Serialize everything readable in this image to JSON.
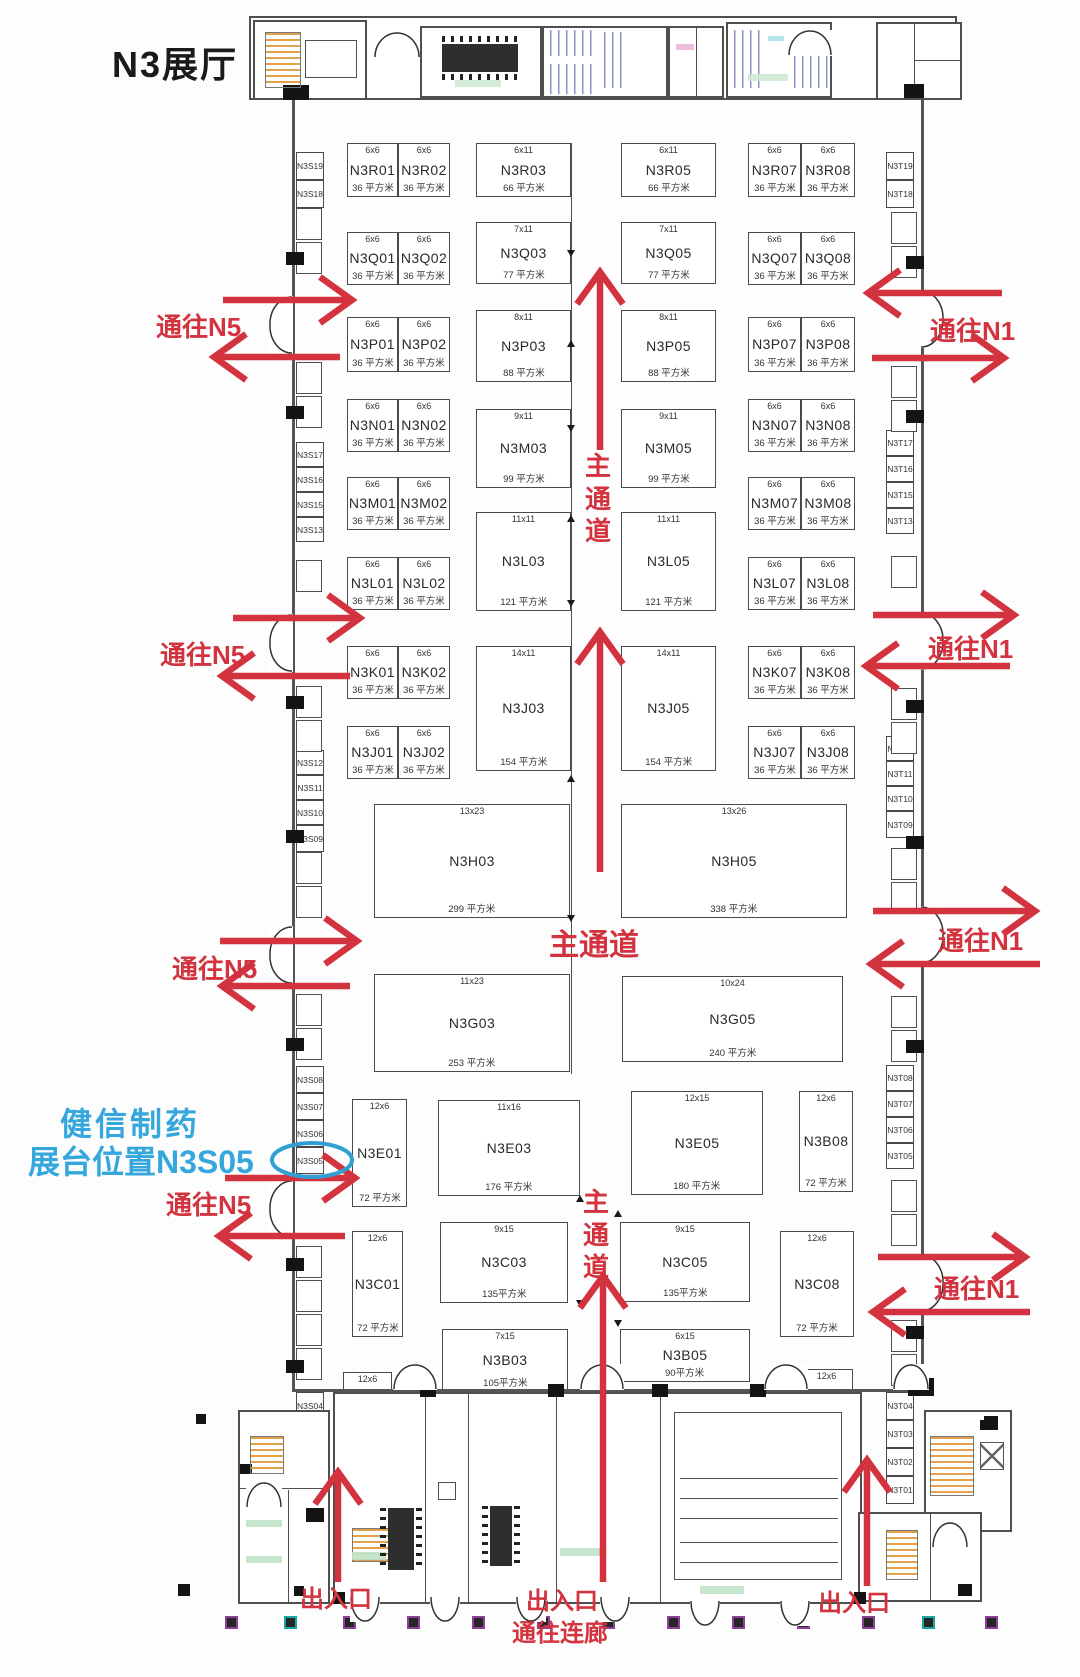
{
  "title": "N3展厅",
  "colors": {
    "red": "#d2333e",
    "blue": "#35a7dc",
    "ink": "#1a1a1a",
    "line": "#4a4a4a",
    "stair_orange": "#e2a24b",
    "column_purple": "#8e3f98",
    "column_teal": "#17a8a2"
  },
  "highlight": {
    "company": "健信制药",
    "location_label": "展台位置N3S05",
    "booth": "N3S05"
  },
  "booths": [
    {
      "name": "N3R01",
      "dim": "6x6",
      "area": "36 平方米",
      "x": 347,
      "y": 143,
      "w": 51,
      "h": 54
    },
    {
      "name": "N3R02",
      "dim": "6x6",
      "area": "36 平方米",
      "x": 398,
      "y": 143,
      "w": 52,
      "h": 54
    },
    {
      "name": "N3R03",
      "dim": "6x11",
      "area": "66 平方米",
      "x": 476,
      "y": 143,
      "w": 95,
      "h": 54
    },
    {
      "name": "N3R05",
      "dim": "6x11",
      "area": "66 平方米",
      "x": 621,
      "y": 143,
      "w": 95,
      "h": 54
    },
    {
      "name": "N3R07",
      "dim": "6x6",
      "area": "36 平方米",
      "x": 748,
      "y": 143,
      "w": 53,
      "h": 54
    },
    {
      "name": "N3R08",
      "dim": "6x6",
      "area": "36 平方米",
      "x": 801,
      "y": 143,
      "w": 54,
      "h": 54
    },
    {
      "name": "N3Q01",
      "dim": "6x6",
      "area": "36 平方米",
      "x": 347,
      "y": 232,
      "w": 51,
      "h": 53
    },
    {
      "name": "N3Q02",
      "dim": "6x6",
      "area": "36 平方米",
      "x": 398,
      "y": 232,
      "w": 52,
      "h": 53
    },
    {
      "name": "N3Q03",
      "dim": "7x11",
      "area": "77 平方米",
      "x": 476,
      "y": 222,
      "w": 95,
      "h": 62
    },
    {
      "name": "N3Q05",
      "dim": "7x11",
      "area": "77 平方米",
      "x": 621,
      "y": 222,
      "w": 95,
      "h": 62
    },
    {
      "name": "N3Q07",
      "dim": "6x6",
      "area": "36 平方米",
      "x": 748,
      "y": 232,
      "w": 53,
      "h": 53
    },
    {
      "name": "N3Q08",
      "dim": "6x6",
      "area": "36 平方米",
      "x": 801,
      "y": 232,
      "w": 54,
      "h": 53
    },
    {
      "name": "N3P01",
      "dim": "6x6",
      "area": "36 平方米",
      "x": 347,
      "y": 317,
      "w": 51,
      "h": 55
    },
    {
      "name": "N3P02",
      "dim": "6x6",
      "area": "36 平方米",
      "x": 398,
      "y": 317,
      "w": 52,
      "h": 55
    },
    {
      "name": "N3P03",
      "dim": "8x11",
      "area": "88 平方米",
      "x": 476,
      "y": 310,
      "w": 95,
      "h": 72
    },
    {
      "name": "N3P05",
      "dim": "8x11",
      "area": "88 平方米",
      "x": 621,
      "y": 310,
      "w": 95,
      "h": 72
    },
    {
      "name": "N3P07",
      "dim": "6x6",
      "area": "36 平方米",
      "x": 748,
      "y": 317,
      "w": 53,
      "h": 55
    },
    {
      "name": "N3P08",
      "dim": "6x6",
      "area": "36 平方米",
      "x": 801,
      "y": 317,
      "w": 54,
      "h": 55
    },
    {
      "name": "N3N01",
      "dim": "6x6",
      "area": "36 平方米",
      "x": 347,
      "y": 399,
      "w": 51,
      "h": 53
    },
    {
      "name": "N3N02",
      "dim": "6x6",
      "area": "36 平方米",
      "x": 398,
      "y": 399,
      "w": 52,
      "h": 53
    },
    {
      "name": "N3N07",
      "dim": "6x6",
      "area": "36 平方米",
      "x": 748,
      "y": 399,
      "w": 53,
      "h": 53
    },
    {
      "name": "N3N08",
      "dim": "6x6",
      "area": "36 平方米",
      "x": 801,
      "y": 399,
      "w": 54,
      "h": 53
    },
    {
      "name": "N3M03",
      "dim": "9x11",
      "area": "99 平方米",
      "x": 476,
      "y": 409,
      "w": 95,
      "h": 79
    },
    {
      "name": "N3M05",
      "dim": "9x11",
      "area": "99 平方米",
      "x": 621,
      "y": 409,
      "w": 95,
      "h": 79
    },
    {
      "name": "N3M01",
      "dim": "6x6",
      "area": "36 平方米",
      "x": 347,
      "y": 477,
      "w": 51,
      "h": 53
    },
    {
      "name": "N3M02",
      "dim": "6x6",
      "area": "36 平方米",
      "x": 398,
      "y": 477,
      "w": 52,
      "h": 53
    },
    {
      "name": "N3M07",
      "dim": "6x6",
      "area": "36 平方米",
      "x": 748,
      "y": 477,
      "w": 53,
      "h": 53
    },
    {
      "name": "N3M08",
      "dim": "6x6",
      "area": "36 平方米",
      "x": 801,
      "y": 477,
      "w": 54,
      "h": 53
    },
    {
      "name": "N3L03",
      "dim": "11x11",
      "area": "121 平方米",
      "x": 476,
      "y": 512,
      "w": 95,
      "h": 99
    },
    {
      "name": "N3L05",
      "dim": "11x11",
      "area": "121 平方米",
      "x": 621,
      "y": 512,
      "w": 95,
      "h": 99
    },
    {
      "name": "N3L01",
      "dim": "6x6",
      "area": "36 平方米",
      "x": 347,
      "y": 557,
      "w": 51,
      "h": 53
    },
    {
      "name": "N3L02",
      "dim": "6x6",
      "area": "36 平方米",
      "x": 398,
      "y": 557,
      "w": 52,
      "h": 53
    },
    {
      "name": "N3L07",
      "dim": "6x6",
      "area": "36 平方米",
      "x": 748,
      "y": 557,
      "w": 53,
      "h": 53
    },
    {
      "name": "N3L08",
      "dim": "6x6",
      "area": "36 平方米",
      "x": 801,
      "y": 557,
      "w": 54,
      "h": 53
    },
    {
      "name": "N3K01",
      "dim": "6x6",
      "area": "36 平方米",
      "x": 347,
      "y": 646,
      "w": 51,
      "h": 53
    },
    {
      "name": "N3K02",
      "dim": "6x6",
      "area": "36 平方米",
      "x": 398,
      "y": 646,
      "w": 52,
      "h": 53
    },
    {
      "name": "N3K07",
      "dim": "6x6",
      "area": "36 平方米",
      "x": 748,
      "y": 646,
      "w": 53,
      "h": 53
    },
    {
      "name": "N3K08",
      "dim": "6x6",
      "area": "36 平方米",
      "x": 801,
      "y": 646,
      "w": 54,
      "h": 53
    },
    {
      "name": "N3J03",
      "dim": "14x11",
      "area": "154 平方米",
      "x": 476,
      "y": 646,
      "w": 95,
      "h": 125
    },
    {
      "name": "N3J05",
      "dim": "14x11",
      "area": "154 平方米",
      "x": 621,
      "y": 646,
      "w": 95,
      "h": 125
    },
    {
      "name": "N3J01",
      "dim": "6x6",
      "area": "36 平方米",
      "x": 347,
      "y": 726,
      "w": 51,
      "h": 53
    },
    {
      "name": "N3J02",
      "dim": "6x6",
      "area": "36 平方米",
      "x": 398,
      "y": 726,
      "w": 52,
      "h": 53
    },
    {
      "name": "N3J07",
      "dim": "6x6",
      "area": "36 平方米",
      "x": 748,
      "y": 726,
      "w": 53,
      "h": 53
    },
    {
      "name": "N3J08",
      "dim": "6x6",
      "area": "36 平方米",
      "x": 801,
      "y": 726,
      "w": 54,
      "h": 53
    },
    {
      "name": "N3H03",
      "dim": "13x23",
      "area": "299 平方米",
      "x": 374,
      "y": 804,
      "w": 196,
      "h": 114
    },
    {
      "name": "N3H05",
      "dim": "13x26",
      "area": "338 平方米",
      "x": 621,
      "y": 804,
      "w": 226,
      "h": 114
    },
    {
      "name": "N3G03",
      "dim": "11x23",
      "area": "253 平方米",
      "x": 374,
      "y": 974,
      "w": 196,
      "h": 98
    },
    {
      "name": "N3G05",
      "dim": "10x24",
      "area": "240 平方米",
      "x": 622,
      "y": 976,
      "w": 221,
      "h": 86
    },
    {
      "name": "N3E01",
      "dim": "12x6",
      "area": "72 平方米",
      "x": 352,
      "y": 1099,
      "w": 55,
      "h": 108
    },
    {
      "name": "N3E03",
      "dim": "11x16",
      "area": "176 平方米",
      "x": 438,
      "y": 1100,
      "w": 142,
      "h": 96
    },
    {
      "name": "N3E05",
      "dim": "12x15",
      "area": "180 平方米",
      "x": 631,
      "y": 1091,
      "w": 132,
      "h": 104
    },
    {
      "name": "N3B08",
      "dim": "12x6",
      "area": "72 平方米",
      "x": 799,
      "y": 1091,
      "w": 54,
      "h": 101
    },
    {
      "name": "N3C01",
      "dim": "12x6",
      "area": "72 平方米",
      "x": 352,
      "y": 1231,
      "w": 51,
      "h": 106
    },
    {
      "name": "N3C03",
      "dim": "9x15",
      "area": "135平方米",
      "x": 440,
      "y": 1222,
      "w": 128,
      "h": 81
    },
    {
      "name": "N3C05",
      "dim": "9x15",
      "area": "135平方米",
      "x": 620,
      "y": 1222,
      "w": 130,
      "h": 80
    },
    {
      "name": "N3C08",
      "dim": "12x6",
      "area": "72 平方米",
      "x": 780,
      "y": 1231,
      "w": 74,
      "h": 106
    },
    {
      "name": "N3B03",
      "dim": "7x15",
      "area": "105平方米",
      "x": 442,
      "y": 1329,
      "w": 126,
      "h": 63
    },
    {
      "name": "N3B05",
      "dim": "6x15",
      "area": "90平方米",
      "x": 620,
      "y": 1329,
      "w": 130,
      "h": 53
    },
    {
      "name": "N3A01",
      "dim": "12x6",
      "area": "72 平方米",
      "x": 343,
      "y": 1372,
      "w": 49,
      "h": 106
    },
    {
      "name": "N3A03",
      "dim": "7x15",
      "area": "105平方米",
      "x": 442,
      "y": 1414,
      "w": 126,
      "h": 64
    },
    {
      "name": "N3A05",
      "dim": "8x15",
      "area": "120平方米",
      "x": 632,
      "y": 1407,
      "w": 131,
      "h": 73
    },
    {
      "name": "N3A08",
      "dim": "12x6",
      "area": "72 平方米",
      "x": 800,
      "y": 1369,
      "w": 53,
      "h": 109
    }
  ],
  "side_booths": {
    "left": {
      "x": 296,
      "w": 28,
      "items": [
        {
          "label": "N3S19",
          "y": 152,
          "h": 28
        },
        {
          "label": "N3S18",
          "y": 180,
          "h": 28
        },
        {
          "label": "N3S17",
          "y": 442,
          "h": 25
        },
        {
          "label": "N3S16",
          "y": 467,
          "h": 25
        },
        {
          "label": "N3S15",
          "y": 492,
          "h": 25
        },
        {
          "label": "N3S13",
          "y": 517,
          "h": 25
        },
        {
          "label": "N3S12",
          "y": 750,
          "h": 25
        },
        {
          "label": "N3S11",
          "y": 775,
          "h": 25
        },
        {
          "label": "N3S10",
          "y": 800,
          "h": 25
        },
        {
          "label": "N3S09",
          "y": 825,
          "h": 27
        },
        {
          "label": "N3S08",
          "y": 1066,
          "h": 27
        },
        {
          "label": "N3S07",
          "y": 1093,
          "h": 27
        },
        {
          "label": "N3S06",
          "y": 1120,
          "h": 27
        },
        {
          "label": "N3S05",
          "y": 1147,
          "h": 27
        },
        {
          "label": "N3S04",
          "y": 1392,
          "h": 27
        },
        {
          "label": "N3S03",
          "y": 1419,
          "h": 27
        },
        {
          "label": "N3S02",
          "y": 1446,
          "h": 27
        },
        {
          "label": "N3S01",
          "y": 1473,
          "h": 27
        }
      ]
    },
    "right": {
      "x": 886,
      "w": 28,
      "items": [
        {
          "label": "N3T19",
          "y": 152,
          "h": 28
        },
        {
          "label": "N3T18",
          "y": 180,
          "h": 28
        },
        {
          "label": "N3T17",
          "y": 430,
          "h": 26
        },
        {
          "label": "N3T16",
          "y": 456,
          "h": 26
        },
        {
          "label": "N3T15",
          "y": 482,
          "h": 26
        },
        {
          "label": "N3T13",
          "y": 508,
          "h": 26
        },
        {
          "label": "N3T12",
          "y": 736,
          "h": 25
        },
        {
          "label": "N3T11",
          "y": 761,
          "h": 25
        },
        {
          "label": "N3T10",
          "y": 786,
          "h": 25
        },
        {
          "label": "N3T09",
          "y": 811,
          "h": 27
        },
        {
          "label": "N3T08",
          "y": 1065,
          "h": 26
        },
        {
          "label": "N3T07",
          "y": 1091,
          "h": 26
        },
        {
          "label": "N3T06",
          "y": 1117,
          "h": 26
        },
        {
          "label": "N3T05",
          "y": 1143,
          "h": 26
        },
        {
          "label": "N3T04",
          "y": 1392,
          "h": 28
        },
        {
          "label": "N3T03",
          "y": 1420,
          "h": 28
        },
        {
          "label": "N3T02",
          "y": 1448,
          "h": 28
        },
        {
          "label": "N3T01",
          "y": 1476,
          "h": 28
        }
      ]
    }
  },
  "floating_texts": [
    {
      "name": "page-title",
      "text": "N3展厅",
      "x": 112,
      "y": 44,
      "size": 36,
      "color": "ink",
      "ls": 2
    },
    {
      "name": "to-n5-1",
      "text": "通往N5",
      "x": 156,
      "y": 312,
      "size": 26,
      "color": "red"
    },
    {
      "name": "to-n5-2",
      "text": "通往N5",
      "x": 160,
      "y": 640,
      "size": 26,
      "color": "red"
    },
    {
      "name": "to-n5-3",
      "text": "通往N5",
      "x": 172,
      "y": 954,
      "size": 26,
      "color": "red"
    },
    {
      "name": "to-n5-4",
      "text": "通往N5",
      "x": 166,
      "y": 1190,
      "size": 26,
      "color": "red"
    },
    {
      "name": "to-n1-1",
      "text": "通往N1",
      "x": 930,
      "y": 316,
      "size": 26,
      "color": "red"
    },
    {
      "name": "to-n1-2",
      "text": "通往N1",
      "x": 928,
      "y": 634,
      "size": 26,
      "color": "red"
    },
    {
      "name": "to-n1-3",
      "text": "通往N1",
      "x": 938,
      "y": 926,
      "size": 26,
      "color": "red"
    },
    {
      "name": "to-n1-4",
      "text": "通往N1",
      "x": 934,
      "y": 1274,
      "size": 26,
      "color": "red"
    },
    {
      "name": "main-aisle-upper",
      "text": "主通道",
      "x": 585,
      "y": 450,
      "size": 26,
      "color": "red",
      "vertical": true
    },
    {
      "name": "main-aisle-horizontal",
      "text": "主通道",
      "x": 549,
      "y": 928,
      "size": 30,
      "color": "red"
    },
    {
      "name": "main-aisle-lower",
      "text": "主通道",
      "x": 583,
      "y": 1186,
      "size": 26,
      "color": "red",
      "vertical": true
    },
    {
      "name": "entrance-left",
      "text": "出入口",
      "x": 300,
      "y": 1586,
      "size": 24,
      "color": "red"
    },
    {
      "name": "entrance-center",
      "text": "出入口",
      "x": 526,
      "y": 1588,
      "size": 24,
      "color": "red"
    },
    {
      "name": "corridor-link",
      "text": "通往连廊",
      "x": 512,
      "y": 1620,
      "size": 24,
      "color": "red"
    },
    {
      "name": "entrance-right",
      "text": "出入口",
      "x": 818,
      "y": 1590,
      "size": 24,
      "color": "red"
    },
    {
      "name": "highlight-company",
      "text": "健信制药",
      "x": 60,
      "y": 1106,
      "size": 32,
      "color": "blue",
      "ls": 3
    },
    {
      "name": "highlight-location",
      "text": "展台位置N3S05",
      "x": 28,
      "y": 1144,
      "size": 32,
      "color": "blue"
    }
  ],
  "arrows": [
    {
      "name": "arrow-n5-1-in",
      "x1": 223,
      "y1": 300,
      "x2": 352,
      "y2": 300
    },
    {
      "name": "arrow-n5-1-out",
      "x1": 340,
      "y1": 357,
      "x2": 214,
      "y2": 357
    },
    {
      "name": "arrow-n5-2-in",
      "x1": 233,
      "y1": 618,
      "x2": 360,
      "y2": 618
    },
    {
      "name": "arrow-n5-2-out",
      "x1": 350,
      "y1": 676,
      "x2": 222,
      "y2": 676
    },
    {
      "name": "arrow-n5-3-in",
      "x1": 220,
      "y1": 941,
      "x2": 357,
      "y2": 941
    },
    {
      "name": "arrow-n5-3-out",
      "x1": 350,
      "y1": 986,
      "x2": 222,
      "y2": 986
    },
    {
      "name": "arrow-n5-4-in",
      "x1": 225,
      "y1": 1178,
      "x2": 355,
      "y2": 1178
    },
    {
      "name": "arrow-n5-4-out",
      "x1": 345,
      "y1": 1236,
      "x2": 219,
      "y2": 1236
    },
    {
      "name": "arrow-n1-1-out",
      "x1": 1002,
      "y1": 293,
      "x2": 868,
      "y2": 293
    },
    {
      "name": "arrow-n1-1-in",
      "x1": 872,
      "y1": 358,
      "x2": 1004,
      "y2": 358
    },
    {
      "name": "arrow-n1-2-in",
      "x1": 873,
      "y1": 615,
      "x2": 1014,
      "y2": 615
    },
    {
      "name": "arrow-n1-2-out",
      "x1": 1010,
      "y1": 666,
      "x2": 866,
      "y2": 666
    },
    {
      "name": "arrow-n1-3-in",
      "x1": 873,
      "y1": 911,
      "x2": 1035,
      "y2": 911
    },
    {
      "name": "arrow-n1-3-out",
      "x1": 1040,
      "y1": 964,
      "x2": 871,
      "y2": 964
    },
    {
      "name": "arrow-n1-4-in",
      "x1": 878,
      "y1": 1257,
      "x2": 1025,
      "y2": 1257
    },
    {
      "name": "arrow-n1-4-out",
      "x1": 1030,
      "y1": 1312,
      "x2": 873,
      "y2": 1312
    },
    {
      "name": "arrow-main-aisle-upper",
      "x1": 600,
      "y1": 450,
      "x2": 600,
      "y2": 272
    },
    {
      "name": "arrow-main-aisle-mid",
      "x1": 600,
      "y1": 872,
      "x2": 600,
      "y2": 632
    },
    {
      "name": "arrow-main-aisle-lower",
      "x1": 603,
      "y1": 1582,
      "x2": 603,
      "y2": 1276
    },
    {
      "name": "arrow-entrance-left",
      "x1": 338,
      "y1": 1582,
      "x2": 338,
      "y2": 1472
    },
    {
      "name": "arrow-entrance-right",
      "x1": 867,
      "y1": 1586,
      "x2": 867,
      "y2": 1460
    }
  ]
}
